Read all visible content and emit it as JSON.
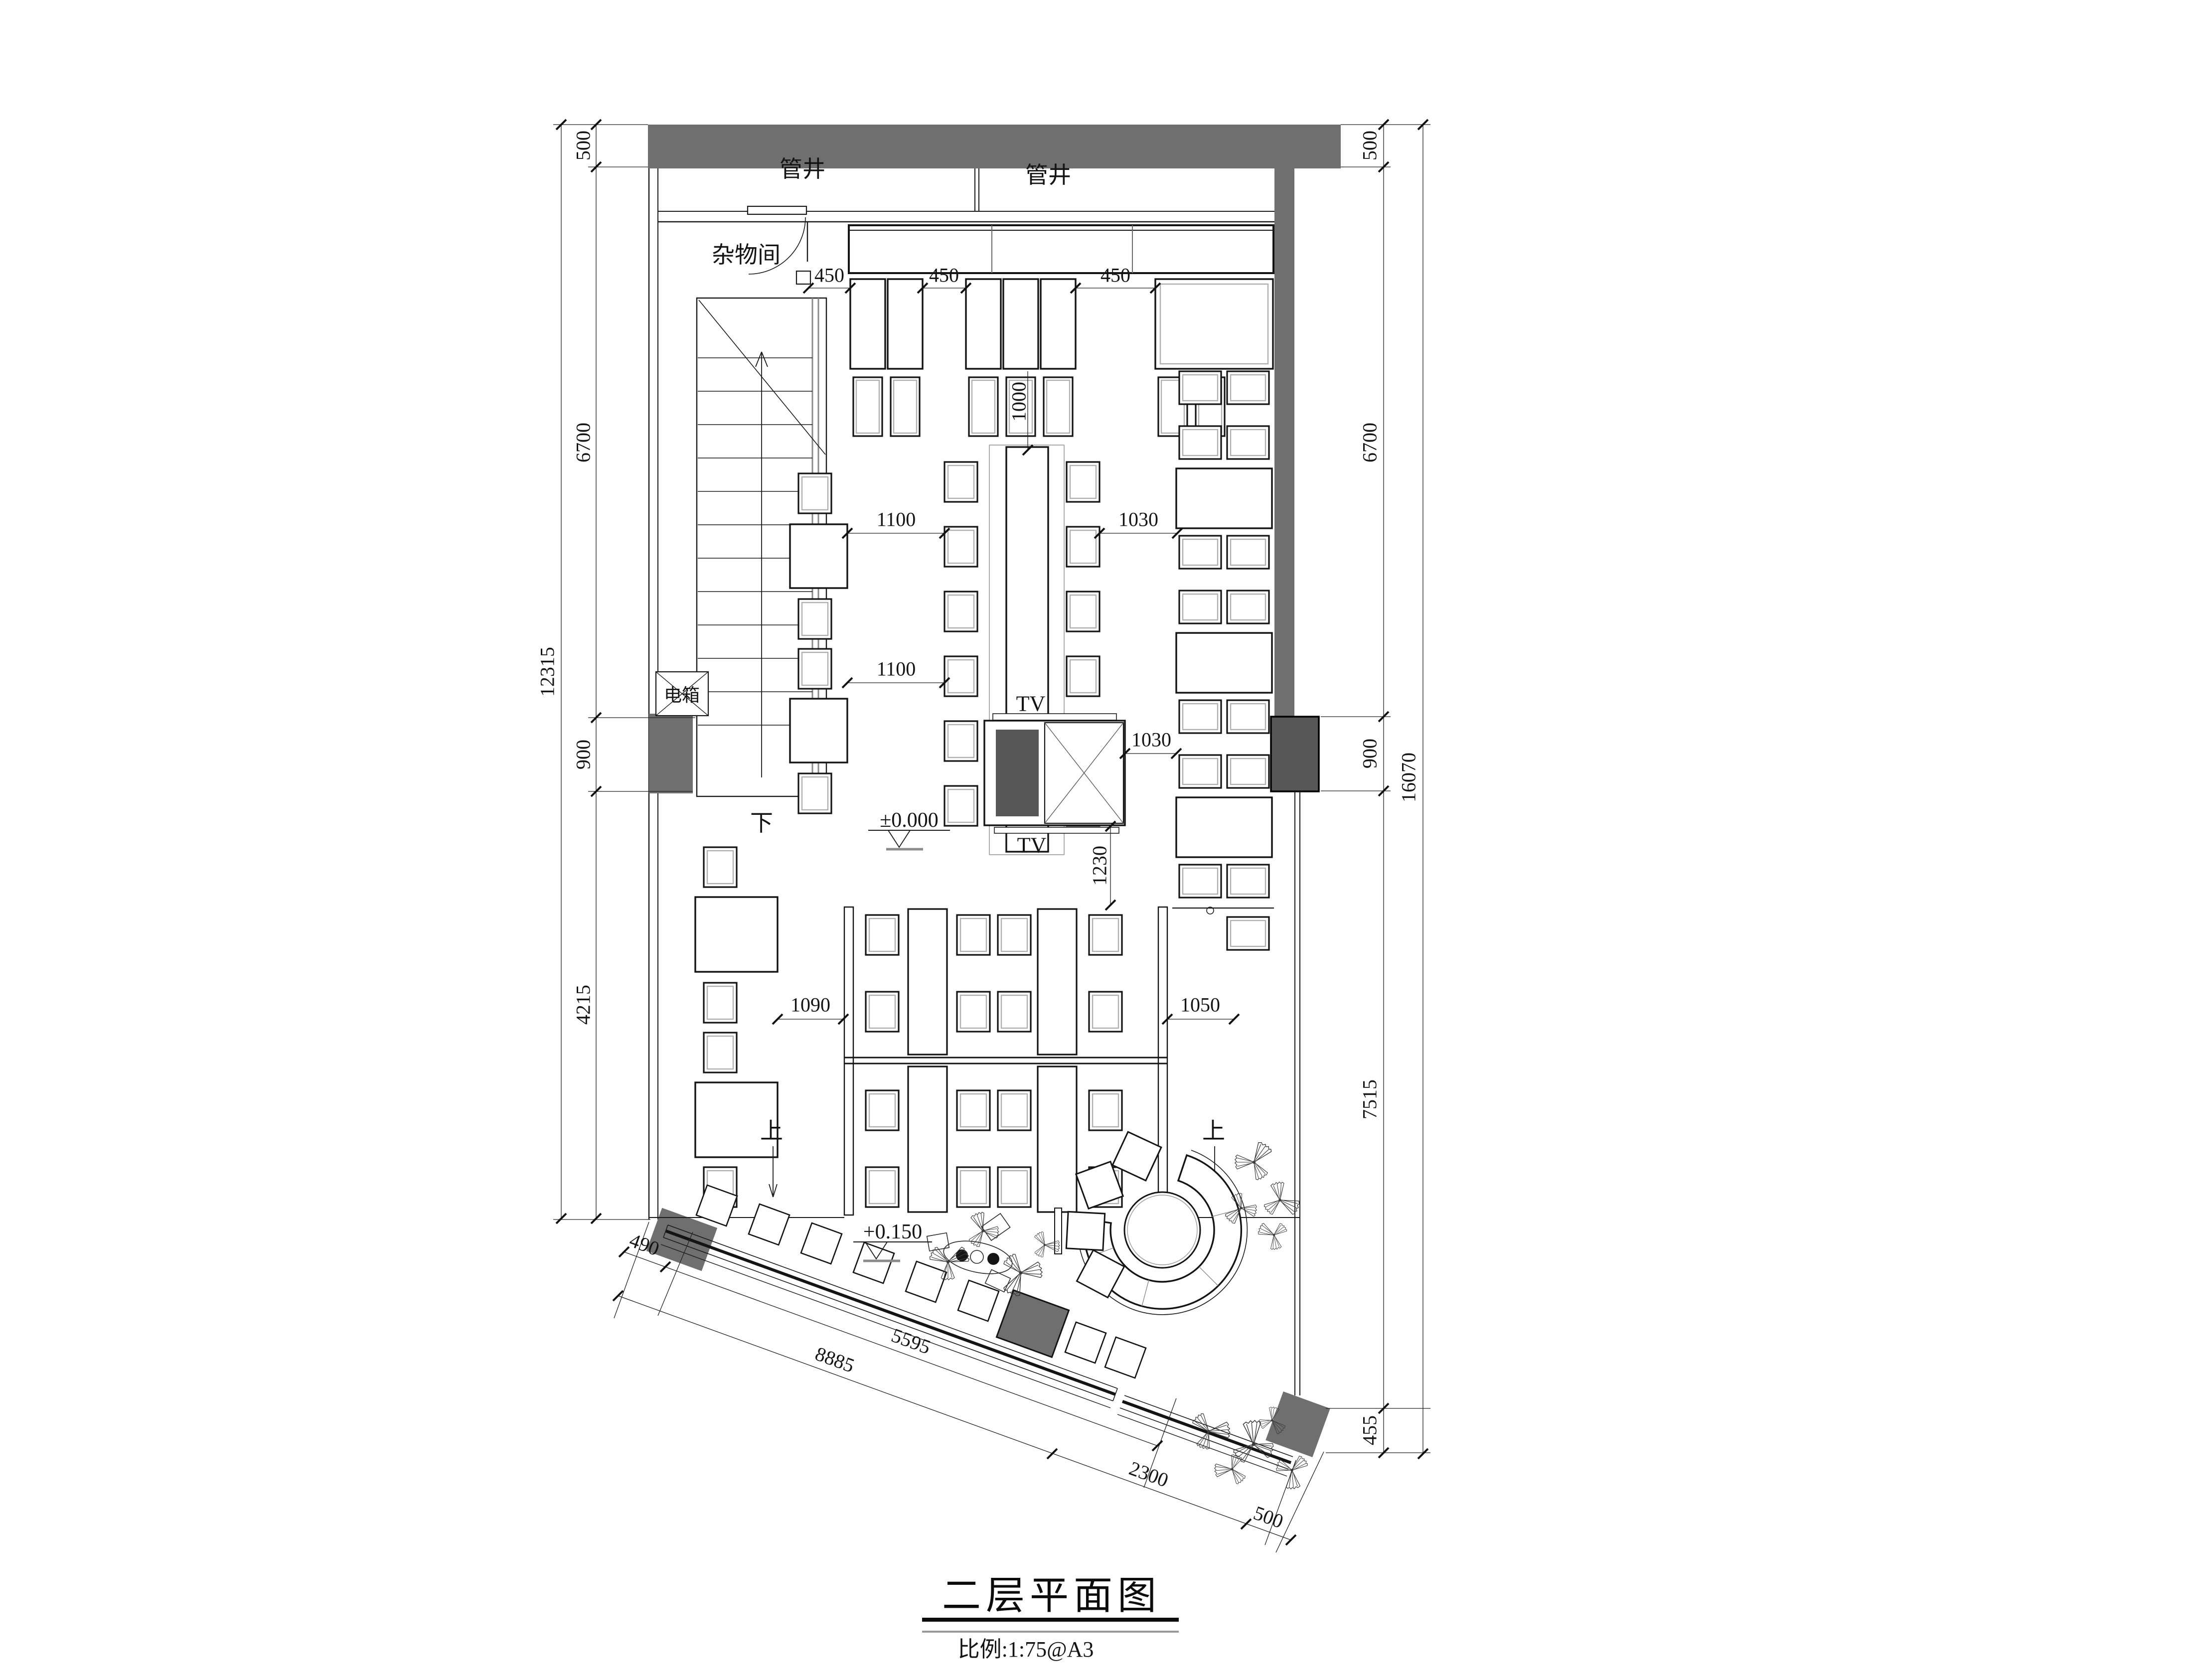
{
  "sheet": {
    "title": "二层平面图",
    "scale_note": "比例:1:75@A3"
  },
  "rooms": {
    "pipe_shaft_1": "管井",
    "pipe_shaft_2": "管井",
    "storage": "杂物间",
    "electric_box": "电箱"
  },
  "stairs": {
    "down": "下",
    "up_left": "上",
    "up_right": "上"
  },
  "levels": {
    "main_floor": "±0.000",
    "terrace": "+0.150"
  },
  "equipment": {
    "tv_top": "TV",
    "tv_bottom": "TV"
  },
  "dimensions": {
    "left_overall": "12315",
    "left_chain": [
      "500",
      "6700",
      "900",
      "4215"
    ],
    "right_overall": "16070",
    "right_chain": [
      "500",
      "6700",
      "900",
      "7515",
      "455"
    ],
    "top_seat_gaps": [
      "450",
      "450",
      "450"
    ],
    "interior": {
      "long_table_offset": "1000",
      "left_aisle_upper": "1100",
      "left_aisle_lower": "1100",
      "right_aisle_upper": "1030",
      "right_aisle_lower": "1030",
      "column_to_booth": "1230",
      "booth_aisle_left": "1090",
      "booth_aisle_right": "1050"
    },
    "bottom_chain": [
      "490",
      "5595",
      "8885",
      "2300",
      "500"
    ]
  },
  "colors": {
    "wall_fill": "#6f6f6f",
    "column_fill": "#575757",
    "line": "#1a1a1a",
    "inner_line": "#b0b0b0"
  }
}
